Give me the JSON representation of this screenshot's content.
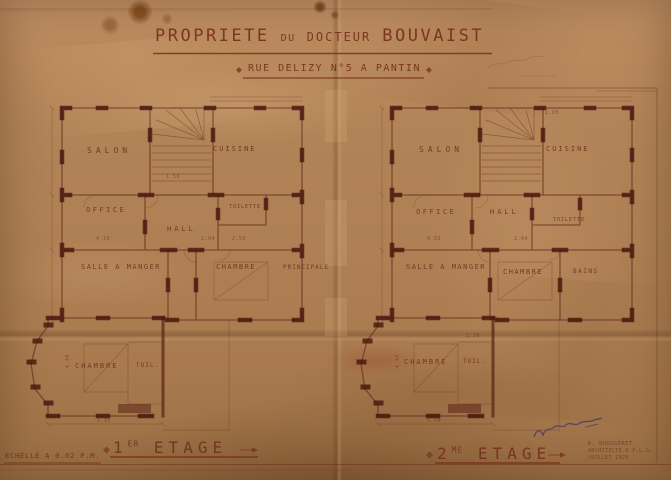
{
  "colors": {
    "ink": "#6e2f1f",
    "paper": "#b28457",
    "signature_ink": "#3b2f72"
  },
  "header": {
    "title_parts": [
      "PROPRIETE",
      "DU",
      "DOCTEUR",
      "BOUVAIST"
    ],
    "subtitle": "RUE DELIZY N°5 A PANTIN"
  },
  "plans": [
    {
      "id": "1er-etage",
      "floor_number": "1",
      "floor_suffix": "ER",
      "floor_word": "ETAGE",
      "rooms": {
        "salon": "SALON",
        "cuisine": "CUISINE",
        "office": "OFFICE",
        "toilette": "TOILETTE",
        "hall": "HALL",
        "salle_a_manger": "SALLE A MANGER",
        "chambre_1": "CHAMBRE",
        "chambre_1b": "PRINCIPALE",
        "chambre_2": "CHAMBRE",
        "toil": "TOIL."
      },
      "dims": [
        "4.10",
        "2.04",
        "2.50",
        "1.50",
        "4.40",
        "5.95"
      ]
    },
    {
      "id": "2me-etage",
      "floor_number": "2",
      "floor_suffix": "ME",
      "floor_word": "ETAGE",
      "rooms": {
        "salon": "SALON",
        "cuisine": "CUISINE",
        "office": "OFFICE",
        "hall": "HALL",
        "toilette": "TOILETTE",
        "salle_a_manger": "SALLE A MANGER",
        "chambre_1": "CHAMBRE",
        "bains": "BAINS",
        "chambre_2": "CHAMBRE",
        "toil": "TOIL."
      },
      "dims": [
        "2.05",
        "4.02",
        "2.04",
        "4.45",
        "1.38",
        "5.50"
      ]
    }
  ],
  "footer": {
    "scale": "ECHELLE A 0.02 P.M.",
    "architect": [
      "R. BOUGGERET",
      "ARCHITECTE D.P.L.G.",
      "JUILLET 1925"
    ]
  }
}
